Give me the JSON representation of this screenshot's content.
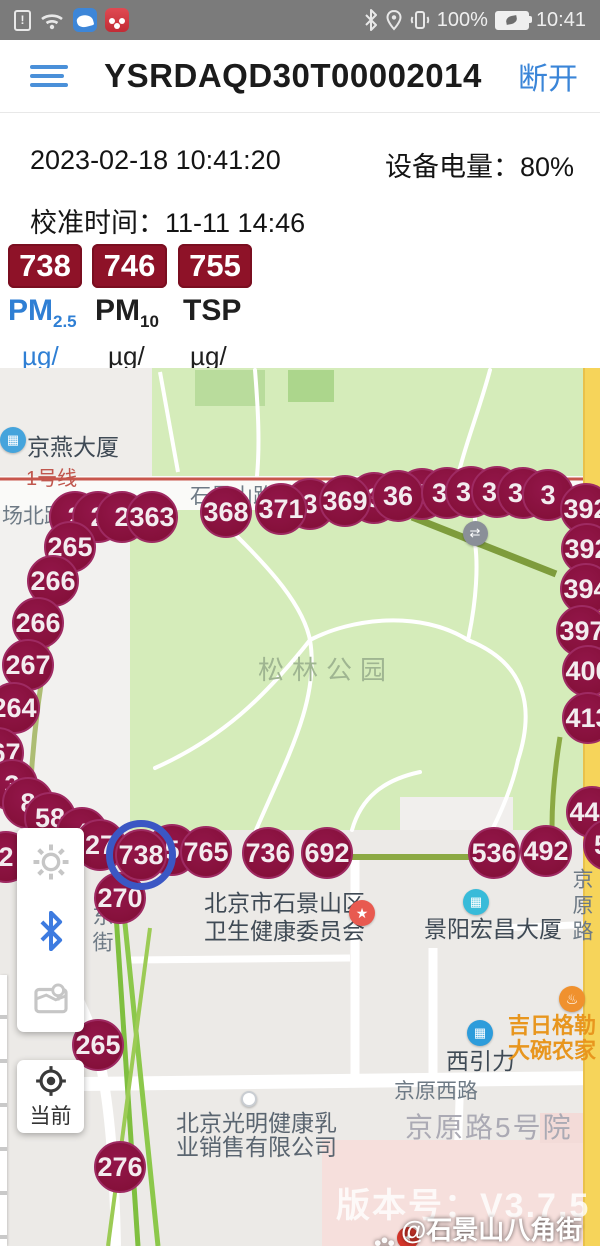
{
  "status_bar": {
    "time": "10:41",
    "battery_pct": "100%",
    "left_icons": [
      "sim-alert",
      "wifi",
      "messenger-app",
      "media-app"
    ],
    "right_icons": [
      "bluetooth",
      "location",
      "vibrate",
      "battery"
    ]
  },
  "header": {
    "title": "YSRDAQD30T00002014",
    "disconnect_label": "断开"
  },
  "info": {
    "timestamp": "2023-02-18 10:41:20",
    "device_battery": "设备电量：80%",
    "calibration": "校准时间：11-11 14:46"
  },
  "readings": {
    "items": [
      {
        "value": "738",
        "name": "PM",
        "subscript": "2.5",
        "unit": "µg/\nm³",
        "active": true
      },
      {
        "value": "746",
        "name": "PM",
        "subscript": "10",
        "unit": "µg/\nm³",
        "active": false
      },
      {
        "value": "755",
        "name": "TSP",
        "subscript": "",
        "unit": "µg/\nm³",
        "active": false
      }
    ]
  },
  "map": {
    "park_name": "松林公园",
    "markers": [
      {
        "x": 75,
        "y": 517,
        "label": "2"
      },
      {
        "x": 98,
        "y": 517,
        "label": "2"
      },
      {
        "x": 122,
        "y": 517,
        "label": "2"
      },
      {
        "x": 152,
        "y": 517,
        "label": "363"
      },
      {
        "x": 310,
        "y": 504,
        "label": "3"
      },
      {
        "x": 226,
        "y": 512,
        "label": "368"
      },
      {
        "x": 281,
        "y": 509,
        "label": "371"
      },
      {
        "x": 374,
        "y": 498,
        "label": "3"
      },
      {
        "x": 345,
        "y": 501,
        "label": "369"
      },
      {
        "x": 422,
        "y": 494,
        "label": "3"
      },
      {
        "x": 398,
        "y": 496,
        "label": "36"
      },
      {
        "x": 447,
        "y": 493,
        "label": "37"
      },
      {
        "x": 471,
        "y": 492,
        "label": "38"
      },
      {
        "x": 497,
        "y": 492,
        "label": "38"
      },
      {
        "x": 523,
        "y": 493,
        "label": "38"
      },
      {
        "x": 548,
        "y": 495,
        "label": "3"
      },
      {
        "x": 586,
        "y": 509,
        "label": "392"
      },
      {
        "x": 587,
        "y": 549,
        "label": "392"
      },
      {
        "x": 586,
        "y": 589,
        "label": "394"
      },
      {
        "x": 582,
        "y": 631,
        "label": "397"
      },
      {
        "x": 588,
        "y": 671,
        "label": "400"
      },
      {
        "x": 588,
        "y": 718,
        "label": "413"
      },
      {
        "x": 592,
        "y": 812,
        "label": "445"
      },
      {
        "x": 70,
        "y": 547,
        "label": "265"
      },
      {
        "x": 53,
        "y": 581,
        "label": "266"
      },
      {
        "x": 38,
        "y": 623,
        "label": "266"
      },
      {
        "x": 28,
        "y": 665,
        "label": "267"
      },
      {
        "x": 14,
        "y": 708,
        "label": "264"
      },
      {
        "x": -2,
        "y": 753,
        "label": "267"
      },
      {
        "x": 12,
        "y": 785,
        "label": "3"
      },
      {
        "x": 28,
        "y": 803,
        "label": "8"
      },
      {
        "x": 50,
        "y": 818,
        "label": "58"
      },
      {
        "x": 82,
        "y": 833,
        "label": "4"
      },
      {
        "x": 6,
        "y": 857,
        "label": "2"
      },
      {
        "x": 100,
        "y": 845,
        "label": "27"
      },
      {
        "x": 172,
        "y": 850,
        "label": "5"
      },
      {
        "x": 206,
        "y": 852,
        "label": "765"
      },
      {
        "x": 268,
        "y": 853,
        "label": "736"
      },
      {
        "x": 327,
        "y": 853,
        "label": "692"
      },
      {
        "x": 120,
        "y": 898,
        "label": "270"
      },
      {
        "x": 609,
        "y": 845,
        "label": "54"
      },
      {
        "x": 546,
        "y": 851,
        "label": "492"
      },
      {
        "x": 494,
        "y": 853,
        "label": "536"
      },
      {
        "x": 141,
        "y": 855,
        "label": "738",
        "selected": true
      },
      {
        "x": 98,
        "y": 1045,
        "label": "265"
      },
      {
        "x": 120,
        "y": 1167,
        "label": "276"
      }
    ],
    "labels": [
      {
        "x": 26,
        "y": 462,
        "text": "1号线",
        "cls": "metro"
      },
      {
        "x": 190,
        "y": 480,
        "text": "石景山路",
        "cls": "road"
      },
      {
        "x": 2,
        "y": 500,
        "text": "场北路",
        "cls": "road"
      },
      {
        "x": 27,
        "y": 428,
        "text": "京燕大厦",
        "cls": "poi"
      },
      {
        "x": 258,
        "y": 650,
        "text": "松林公园",
        "cls": "park"
      },
      {
        "x": 86,
        "y": 905,
        "text": "东街",
        "cls": "road vert"
      },
      {
        "x": 204,
        "y": 884,
        "text": "北京市石景山区",
        "cls": "poi"
      },
      {
        "x": 204,
        "y": 912,
        "text": "卫生健康委员会",
        "cls": "poi"
      },
      {
        "x": 424,
        "y": 910,
        "text": "景阳宏昌大厦",
        "cls": "poi"
      },
      {
        "x": 566,
        "y": 868,
        "text": "京原路",
        "cls": "road vert"
      },
      {
        "x": 446,
        "y": 1042,
        "text": "西引力",
        "cls": "poi"
      },
      {
        "x": 508,
        "y": 1008,
        "text": "吉日格勒",
        "cls": "orange"
      },
      {
        "x": 508,
        "y": 1033,
        "text": "大碗农家",
        "cls": "orange"
      },
      {
        "x": 394,
        "y": 1075,
        "text": "京原西路",
        "cls": "road"
      },
      {
        "x": 405,
        "y": 1106,
        "text": "京原路5号院",
        "cls": "big-road"
      },
      {
        "x": 176,
        "y": 1104,
        "text": "北京光明健康乳",
        "cls": "poi2"
      },
      {
        "x": 176,
        "y": 1128,
        "text": "业销售有限公司",
        "cls": "poi2"
      }
    ],
    "pois": [
      {
        "x": 13,
        "y": 440,
        "type": "building",
        "color": "#45A4DC"
      },
      {
        "x": 362,
        "y": 913,
        "type": "star",
        "color": "#E85A50"
      },
      {
        "x": 476,
        "y": 902,
        "type": "building",
        "color": "#38BBD9"
      },
      {
        "x": 480,
        "y": 1033,
        "type": "building",
        "color": "#2D9CDB"
      },
      {
        "x": 572,
        "y": 999,
        "type": "food",
        "color": "#F0912E"
      },
      {
        "x": 475,
        "y": 533,
        "type": "subway",
        "color": "#8A8F98"
      },
      {
        "x": 247,
        "y": 1097,
        "type": "dot",
        "color": "#FFFFFF"
      },
      {
        "x": 408,
        "y": 1238,
        "type": "logo",
        "color": "#D5352B"
      }
    ],
    "controls": {
      "locate_label": "当前"
    },
    "watermark_version": "版本号：V3.7.5",
    "watermark_brand": "@石景山八角街道"
  },
  "colors": {
    "marker": "#8C1540",
    "marker_rim": "#9E2A62",
    "badge_red": "#8E1228",
    "accent_blue": "#3A85D8",
    "selected_ring": "#3B57C4",
    "park_green": "#D5ECBA",
    "yellow_road": "#F6D45A"
  }
}
